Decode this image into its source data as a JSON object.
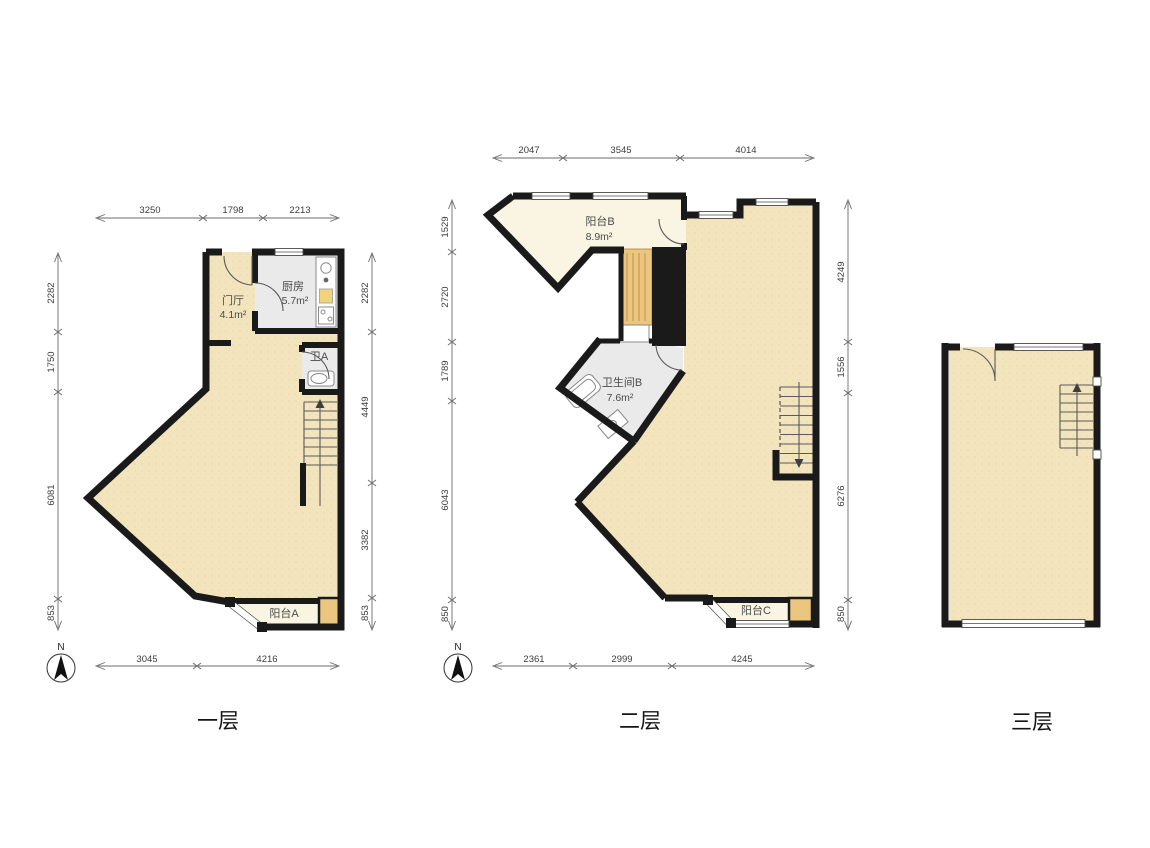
{
  "floors": [
    {
      "caption": "一层",
      "compass": "N",
      "rooms": {
        "hall": {
          "name": "门厅",
          "area": "4.1m²"
        },
        "kitchen": {
          "name": "厨房",
          "area": "5.7m²"
        },
        "bathA": {
          "name": "卫A"
        },
        "balconyA": {
          "name": "阳台A"
        }
      },
      "dims": {
        "top": [
          "3250",
          "1798",
          "2213"
        ],
        "left": [
          "2282",
          "1750",
          "6081",
          "853"
        ],
        "right": [
          "2282",
          "4449",
          "3382",
          "853"
        ],
        "bottom": [
          "3045",
          "4216"
        ]
      }
    },
    {
      "caption": "二层",
      "compass": "N",
      "rooms": {
        "balconyB": {
          "name": "阳台B",
          "area": "8.9m²"
        },
        "bathB": {
          "name": "卫生间B",
          "area": "7.6m²"
        },
        "balconyC": {
          "name": "阳台C"
        }
      },
      "dims": {
        "top": [
          "2047",
          "3545",
          "4014"
        ],
        "left": [
          "1529",
          "2720",
          "1789",
          "6043",
          "850"
        ],
        "right": [
          "4249",
          "1556",
          "6276",
          "850"
        ],
        "bottom": [
          "2361",
          "2999",
          "4245"
        ]
      }
    },
    {
      "caption": "三层"
    }
  ],
  "colors": {
    "wall": "#1a1a1a",
    "floor_main": "#f2e4bd",
    "floor_balcony": "#faf4e2",
    "floor_wet": "#eaeaea",
    "wood": "#eac67f",
    "dim_text": "#3c3c3c"
  }
}
